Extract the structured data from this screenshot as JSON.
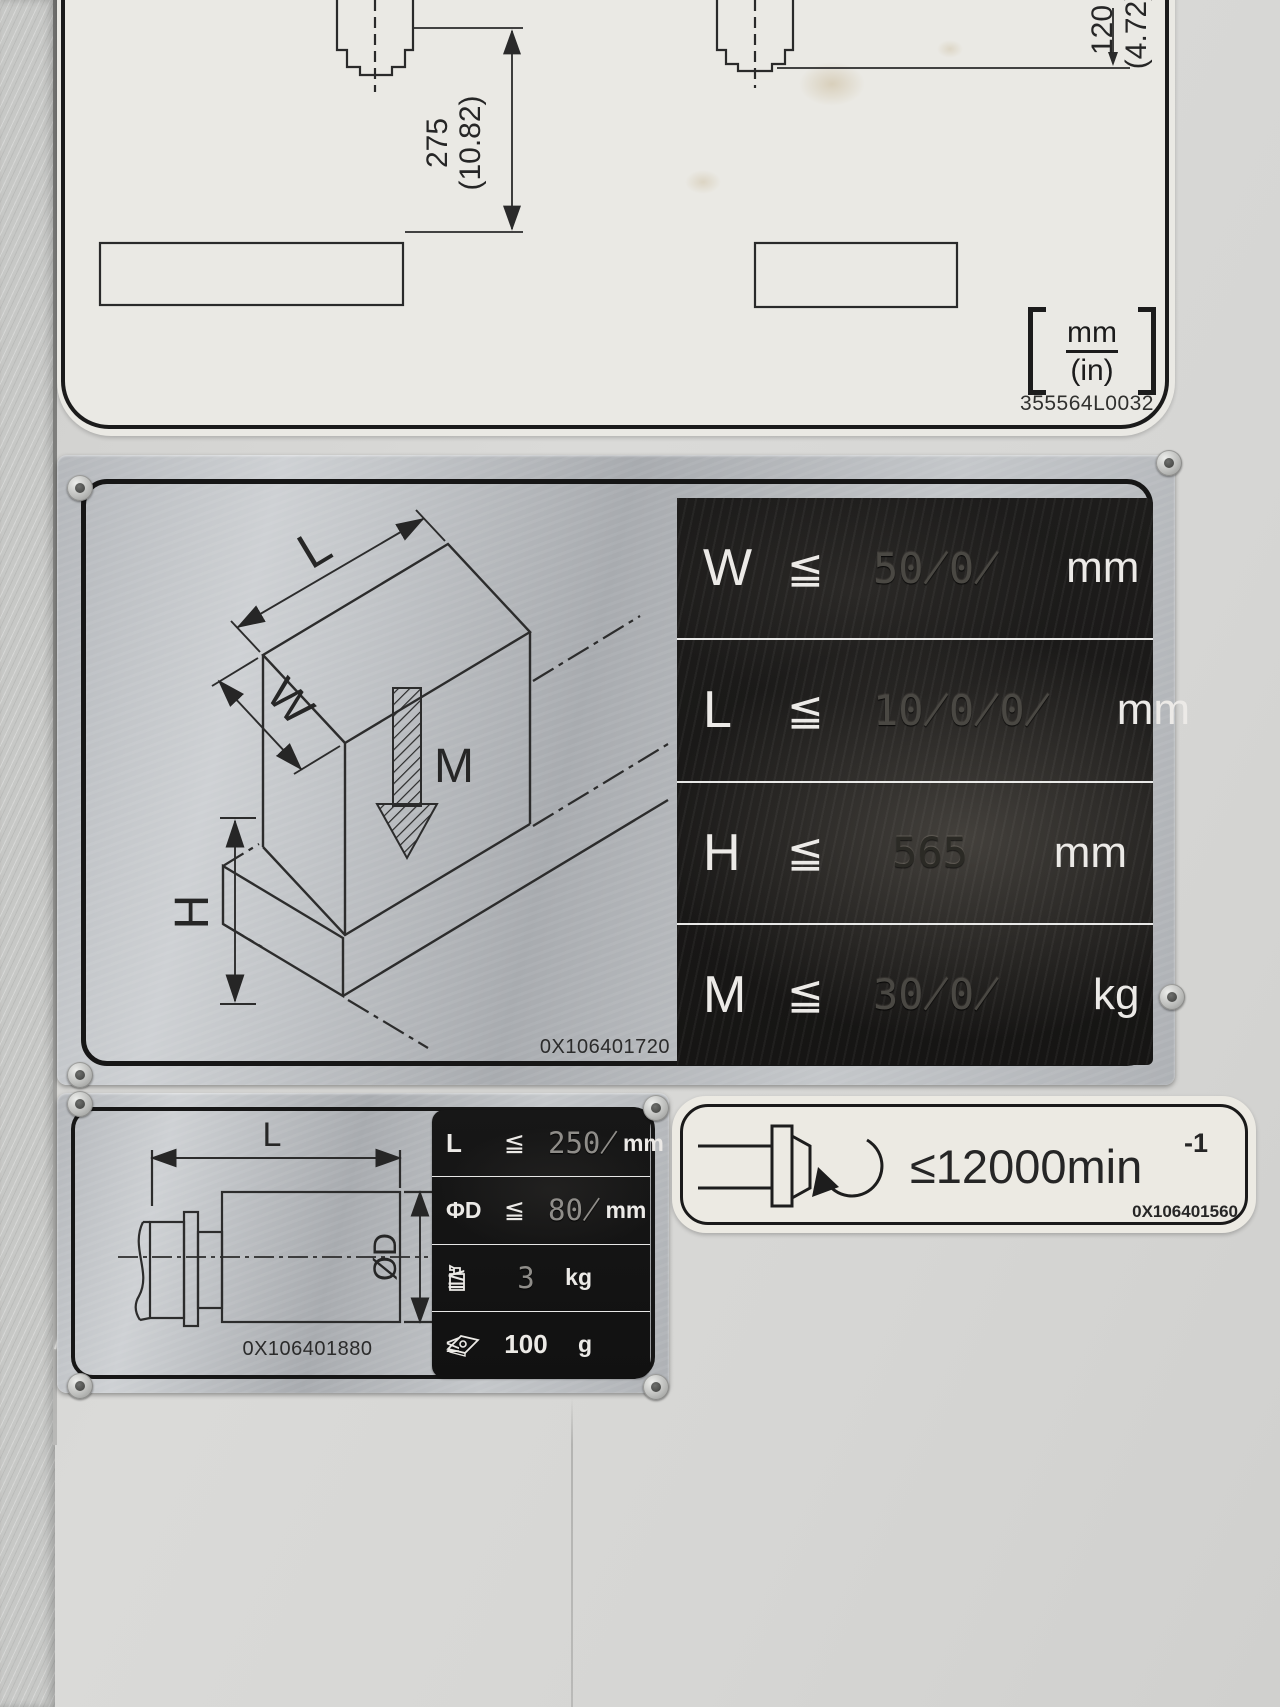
{
  "top_label": {
    "part_number": "355564L0032",
    "dim_vertical": {
      "mm": "275",
      "in": "(10.82)"
    },
    "dim_right": {
      "mm": "120",
      "in": "(4.72)"
    },
    "units": {
      "mm": "mm",
      "in": "(in)"
    }
  },
  "workpiece_label": {
    "part_number": "0X106401720",
    "dim_letters": {
      "L": "L",
      "W": "W",
      "H": "H",
      "M": "M"
    },
    "rows": [
      {
        "symbol": "W",
        "op": "≦",
        "value": "50̸0̸",
        "unit": "mm"
      },
      {
        "symbol": "L",
        "op": "≦",
        "value": "10̸0̸0̸",
        "unit": "mm"
      },
      {
        "symbol": "H",
        "op": "≦",
        "value": "565",
        "unit": "mm"
      },
      {
        "symbol": "M",
        "op": "≦",
        "value": "30̸0̸",
        "unit": "kg"
      }
    ]
  },
  "tool_label": {
    "part_number": "0X106401880",
    "dim_letters": {
      "L": "L",
      "D": "ØD"
    },
    "rows": [
      {
        "symbol": "L",
        "op": "≦",
        "value": "250̸",
        "unit": "mm"
      },
      {
        "symbol": "ΦD",
        "op": "≦",
        "value": "80̸",
        "unit": "mm"
      },
      {
        "symbol": "weight-icon",
        "op": "≦",
        "value": "3",
        "unit": "kg"
      },
      {
        "symbol": "insert-icon",
        "op": "≤",
        "value": "100",
        "unit": "g"
      }
    ]
  },
  "spindle_label": {
    "part_number": "0X106401560",
    "speed_text": "≤12000min",
    "speed_sup": "-1"
  }
}
